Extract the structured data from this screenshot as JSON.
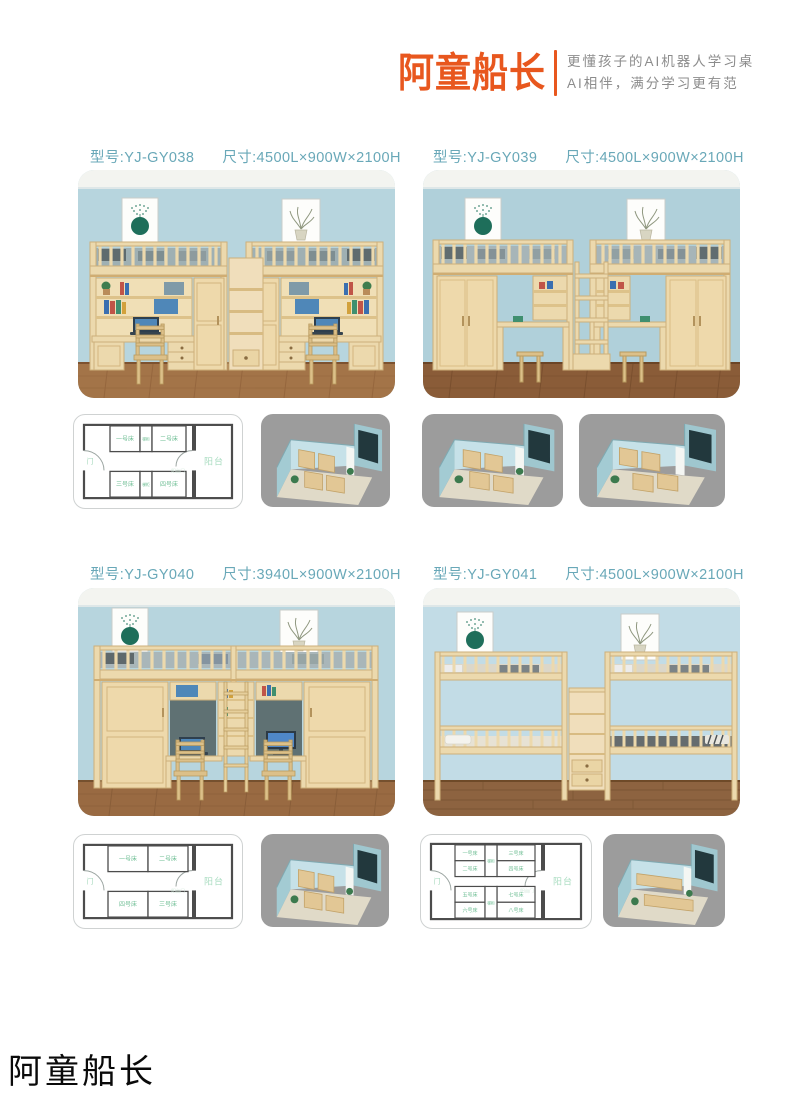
{
  "header": {
    "logo": "阿童船长",
    "tagline1": "更懂孩子的AI机器人学习桌",
    "tagline2": "AI相伴，满分学习更有范"
  },
  "shared": {
    "balcony": "阳台",
    "door": "门",
    "balcony_door": "阳台门",
    "stair_cabinet": "梯柜"
  },
  "products": [
    {
      "model": "型号:YJ-GY038",
      "size": "尺寸:4500L×900W×2100H",
      "plan": {
        "beds": [
          "一号床",
          "二号床",
          "三号床",
          "四号床"
        ]
      }
    },
    {
      "model": "型号:YJ-GY039",
      "size": "尺寸:4500L×900W×2100H"
    },
    {
      "model": "型号:YJ-GY040",
      "size": "尺寸:3940L×900W×2100H",
      "plan": {
        "beds": [
          "一号床",
          "二号床",
          "四号床",
          "三号床"
        ]
      }
    },
    {
      "model": "型号:YJ-GY041",
      "size": "尺寸:4500L×900W×2100H",
      "plan": {
        "beds": [
          "一号床",
          "三号床",
          "二号床",
          "四号床",
          "五号床",
          "七号床",
          "六号床",
          "八号床"
        ]
      }
    }
  ],
  "footer": {
    "brand": "阿童船长"
  },
  "colors": {
    "accent_orange": "#E8571E",
    "label_teal": "#69A8B8",
    "plan_green": "#6BBD92"
  }
}
